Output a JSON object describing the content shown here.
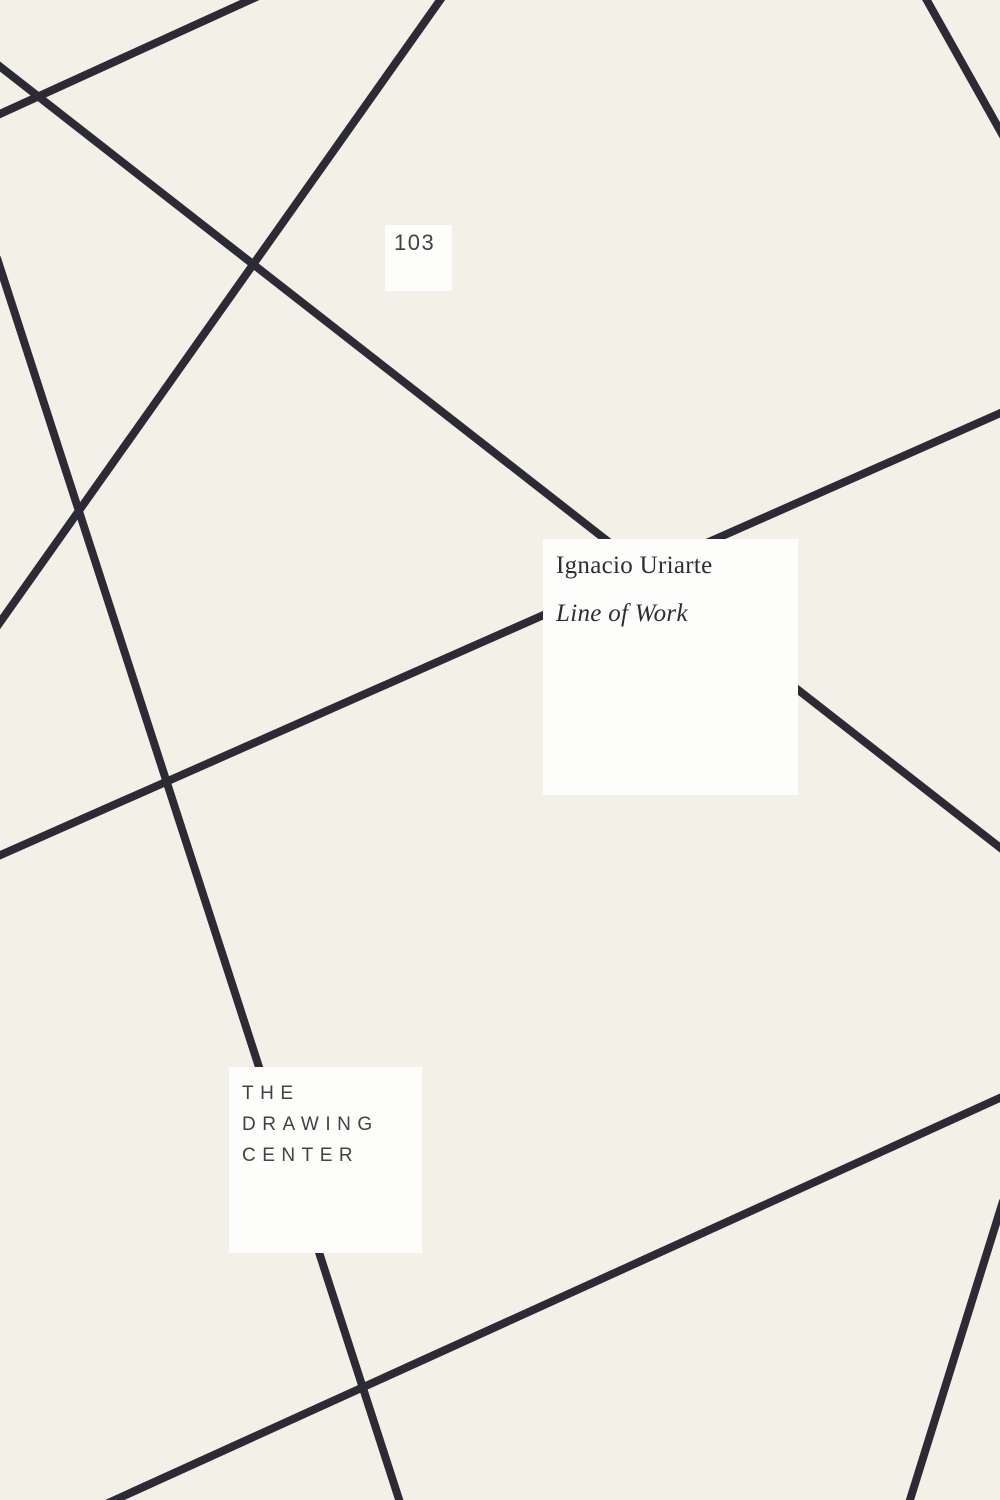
{
  "cover": {
    "page_number": "103",
    "author": "Ignacio Uriarte",
    "title": "Line of Work",
    "publisher_lines": [
      "THE",
      "DRAWING",
      "CENTER"
    ],
    "colors": {
      "background": "#f3f0e7",
      "line": "#2c2a34",
      "panel": "#fdfdfc",
      "text_dark": "#2e2d33",
      "text_gray": "#424242"
    },
    "artwork": {
      "line_thickness": 8,
      "lines": [
        {
          "x1": 250,
          "y1": 0,
          "x2": 0,
          "y2": 114
        },
        {
          "x1": 0,
          "y1": 67,
          "x2": 1000,
          "y2": 848
        },
        {
          "x1": 440,
          "y1": 0,
          "x2": 0,
          "y2": 622
        },
        {
          "x1": 0,
          "y1": 268,
          "x2": 399,
          "y2": 1500
        },
        {
          "x1": 0,
          "y1": 855,
          "x2": 1000,
          "y2": 413
        },
        {
          "x1": 927,
          "y1": 0,
          "x2": 1000,
          "y2": 130
        },
        {
          "x1": 1000,
          "y1": 1098,
          "x2": 115,
          "y2": 1500
        },
        {
          "x1": 1000,
          "y1": 1211,
          "x2": 910,
          "y2": 1500
        }
      ]
    }
  }
}
